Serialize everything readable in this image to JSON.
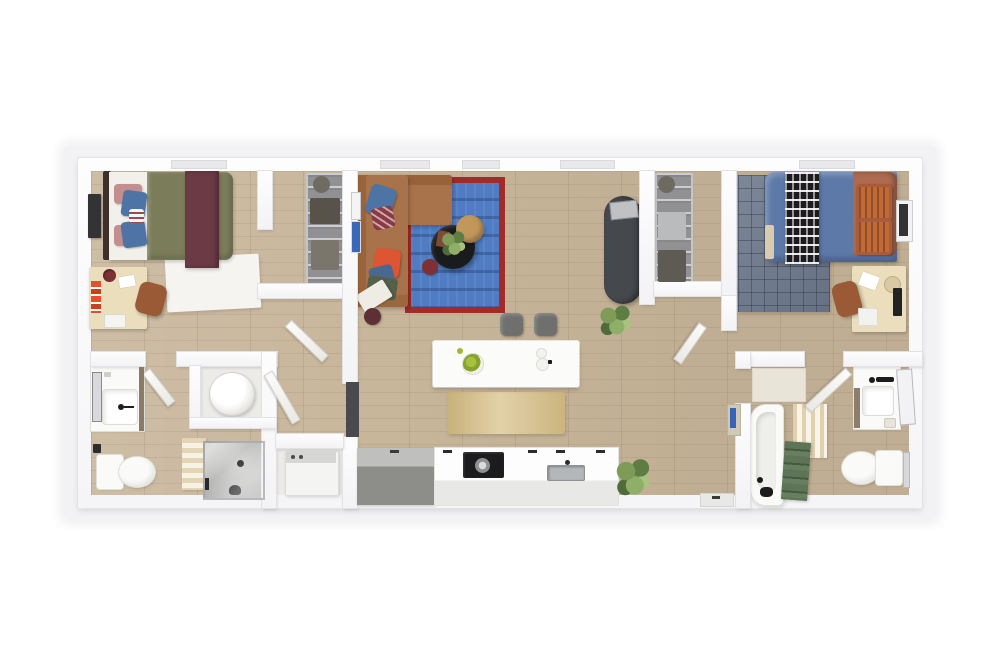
{
  "scene": {
    "type": "3d-floor-plan-top-down-render",
    "description": "Top-down 3D rendering of a two-bedroom, two-bathroom apartment floor plan with central living room and kitchen",
    "text_visible": false,
    "bedrooms": 2,
    "bathrooms": 2
  },
  "palette": {
    "page_bg": "#ffffff",
    "plan_shadow": "#f2f2f4",
    "wall": "#fafafc",
    "floor_wood": "#c8b69b",
    "floor_utility": "#edebe7",
    "rug_bed1": "#f5f4f0",
    "rug_bed2": "#6e7a8d",
    "rug_living": "#4f7cc2",
    "rug_living_border": "#a02b27",
    "runner_kitchen": "#d9c28c",
    "sofa": "#a8724a",
    "sofa_back": "#96603c",
    "pillow_blue": "#4e74a6",
    "pillow_maroon": "#8a3a44",
    "pillow_orange_red": "#dd5533",
    "pillow_olive": "#55604a",
    "pillow_blue_gray": "#49688f",
    "throw_white": "#efece6",
    "coffee_table": "#1a1b1d",
    "side_table": "#c2975c",
    "pouf": "#7e3035",
    "lamp_stool": "#5c3034",
    "fridge": "#45484c",
    "fridge_tray": "#bfc1c3",
    "island": "#fbfbf9",
    "stool": "#6f706d",
    "counter_gray": "#9d9d9a",
    "counter_white": "#f7f7f5",
    "stove": "#1c1c1e",
    "sink_gray": "#b4b7b9",
    "bed1_headboard": "#3f3129",
    "bed1_sheet": "#f2f0ea",
    "bed1_duvet": "#7b7c5a",
    "bed1_throw": "#6b3a45",
    "pillow_pink": "#c28e8e",
    "bed2_duvet": "#5d79a8",
    "bed2_sheet_fold": "#d9cbb0",
    "bed2_headboard": "#ad6a50",
    "bed2_pillow": "#c06a38",
    "throw_bw": "#1c1c1e",
    "desk_wood": "#ebdebc",
    "chair_leather": "#9a5a35",
    "tv_screen": "#333336",
    "monitor_dark": "#232325",
    "shelving_metal": "#919193",
    "shower_floor": "#bcbdbb",
    "fixture_white": "#fafaf8",
    "towel_green": "#5d7456",
    "towel_blue": "#3a63b5",
    "mat_stripe": "#e3d4b4",
    "plant_green": "#6f8d4d",
    "door": "#f6f5f2",
    "window": "#e9e9ec",
    "cabinet_dark": "#4a4a4e",
    "art_blue": "#3a68b8",
    "water_heater": "#f2f1ee",
    "washer": "#f4f4f2"
  },
  "rooms": [
    {
      "name": "bedroom-1",
      "position": "top-left",
      "furniture": [
        "bed-olive-duvet-maroon-throw",
        "headboard-dark",
        "pink-pillows",
        "blue-pillows",
        "wall-tv",
        "white-area-rug",
        "desk",
        "desk-chair",
        "binders",
        "cup"
      ]
    },
    {
      "name": "closet-1",
      "position": "top-left-of-living",
      "furniture": [
        "wire-shelving",
        "storage-bins"
      ]
    },
    {
      "name": "living-room",
      "position": "top-center",
      "furniture": [
        "l-shaped-sectional-sofa",
        "blue-area-rug-red-border",
        "round-coffee-table",
        "plant-on-table",
        "round-side-table",
        "pouf",
        "floor-stool",
        "leaning-art-frames",
        "refrigerator",
        "corner-plant"
      ]
    },
    {
      "name": "kitchen",
      "position": "bottom-center",
      "furniture": [
        "kitchen-island",
        "fruit-bowl",
        "plates",
        "bar-stool",
        "bar-stool",
        "runner-rug",
        "gray-counter",
        "white-counter",
        "range-cooktop",
        "pot",
        "sink",
        "plant"
      ]
    },
    {
      "name": "closet-2",
      "position": "top-right-of-living",
      "furniture": [
        "wire-shelving",
        "storage-bins"
      ]
    },
    {
      "name": "hallway-2",
      "position": "right-of-living",
      "furniture": [
        "open-door",
        "towel-shelf"
      ]
    },
    {
      "name": "bedroom-2",
      "position": "top-right",
      "furniture": [
        "bed-blue-duvet",
        "patterned-throw",
        "rust-headboard",
        "orange-pillows",
        "grid-area-rug",
        "desk",
        "desk-chair",
        "monitor",
        "wall-tv"
      ]
    },
    {
      "name": "bathroom-1",
      "position": "bottom-left",
      "furniture": [
        "vanity-sink",
        "leaning-mirror",
        "toilet",
        "striped-bath-mat",
        "walk-in-shower",
        "glass-door"
      ]
    },
    {
      "name": "utility",
      "position": "bottom-left-center",
      "furniture": [
        "water-heater",
        "washer-dryer"
      ]
    },
    {
      "name": "bathroom-2",
      "position": "bottom-right",
      "furniture": [
        "bathtub",
        "green-towels",
        "striped-bath-mat",
        "vanity-sink",
        "leaning-mirror",
        "toilet",
        "towel-bar",
        "linen-shelf"
      ]
    }
  ],
  "openings": {
    "windows_top_wall": 5,
    "doors_open": [
      "bedroom-1",
      "bathroom-1",
      "utility",
      "bedroom-2",
      "bathroom-2"
    ],
    "entry_threshold": "bottom-wall-right-of-kitchen"
  }
}
